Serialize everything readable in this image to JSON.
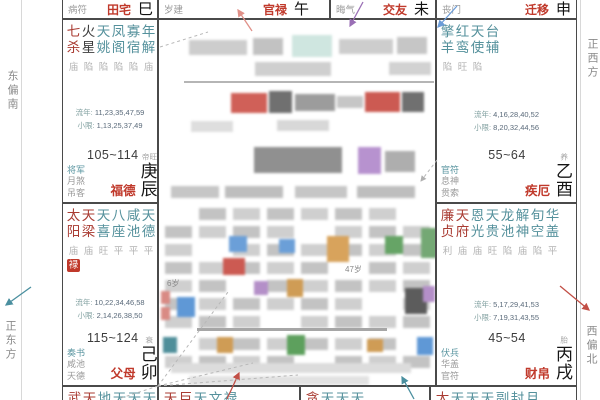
{
  "chart": {
    "directions": {
      "left_top": "东偏南",
      "left_bottom": "正东方",
      "right_top": "正西方",
      "right_bottom": "西偏北"
    },
    "top_strip": [
      {
        "key": "tianzhai",
        "label": "病符",
        "name": "田宅",
        "branch": "巳"
      },
      {
        "key": "guanlu",
        "label": "岁建",
        "name": "官禄",
        "branch": "午"
      },
      {
        "key": "jiaoyou",
        "label": "晦气",
        "name": "交友",
        "branch": "未"
      },
      {
        "key": "qianyi",
        "label": "丧门",
        "name": "迁移",
        "branch": "申"
      }
    ],
    "palaces": [
      {
        "key": "fude",
        "stars": [
          {
            "name": "七杀",
            "status": "庙",
            "type": "major"
          },
          {
            "name": "火星",
            "status": "陷",
            "type": "dark"
          },
          {
            "name": "天姚",
            "status": "陷",
            "type": "minor"
          },
          {
            "name": "凤阁",
            "status": "陷",
            "type": "minor"
          },
          {
            "name": "寡宿",
            "status": "陷",
            "type": "minor"
          },
          {
            "name": "年解",
            "status": "庙",
            "type": "minor"
          }
        ],
        "liunian": {
          "label": "流年:",
          "nums": "11,23,35,47,59"
        },
        "xiaoxian": {
          "label": "小限:",
          "nums": "1,13,25,37,49"
        },
        "shensha": [
          "将军",
          "月煞",
          "吊客"
        ],
        "age": "105~114",
        "name": "福德",
        "stage": "帝旺",
        "stem": "庚",
        "branch": "辰"
      },
      {
        "key": "jie",
        "stars": [
          {
            "name": "擎羊",
            "status": "陷",
            "type": "minor"
          },
          {
            "name": "红鸾",
            "status": "旺",
            "type": "minor"
          },
          {
            "name": "天使",
            "status": "陷",
            "type": "minor"
          },
          {
            "name": "台辅",
            "status": "",
            "type": "minor"
          }
        ],
        "liunian": {
          "label": "流年:",
          "nums": "4,16,28,40,52"
        },
        "xiaoxian": {
          "label": "小限:",
          "nums": "8,20,32,44,56"
        },
        "shensha": [
          "官符",
          "息神",
          "贯索"
        ],
        "age": "55~64",
        "name": "疾厄",
        "stage": "养",
        "stem": "乙",
        "branch": "酉"
      },
      {
        "key": "fumu",
        "stars": [
          {
            "name": "太阳",
            "status": "庙",
            "type": "major",
            "badge": "禄"
          },
          {
            "name": "天梁",
            "status": "庙",
            "type": "major"
          },
          {
            "name": "天喜",
            "status": "旺",
            "type": "minor"
          },
          {
            "name": "八座",
            "status": "平",
            "type": "minor"
          },
          {
            "name": "咸池",
            "status": "平",
            "type": "minor"
          },
          {
            "name": "天德",
            "status": "平",
            "type": "minor"
          }
        ],
        "liunian": {
          "label": "流年:",
          "nums": "10,22,34,46,58"
        },
        "xiaoxian": {
          "label": "小限:",
          "nums": "2,14,26,38,50"
        },
        "shensha": [
          "奏书",
          "咸池",
          "天德"
        ],
        "age": "115~124",
        "name": "父母",
        "stage": "衰",
        "stem": "己",
        "branch": "卯"
      },
      {
        "key": "caibo",
        "stars": [
          {
            "name": "廉贞",
            "status": "利",
            "type": "major"
          },
          {
            "name": "天府",
            "status": "庙",
            "type": "major"
          },
          {
            "name": "恩光",
            "status": "庙",
            "type": "minor"
          },
          {
            "name": "天贵",
            "status": "旺",
            "type": "minor"
          },
          {
            "name": "龙池",
            "status": "陷",
            "type": "minor"
          },
          {
            "name": "解神",
            "status": "庙",
            "type": "minor"
          },
          {
            "name": "旬空",
            "status": "陷",
            "type": "minor"
          },
          {
            "name": "华盖",
            "status": "平",
            "type": "minor"
          }
        ],
        "liunian": {
          "label": "流年:",
          "nums": "5,17,29,41,53"
        },
        "xiaoxian": {
          "label": "小限:",
          "nums": "7,19,31,43,55"
        },
        "shensha": [
          "伏兵",
          "华盖",
          "官符"
        ],
        "age": "45~54",
        "name": "财帛",
        "stage": "胎",
        "stem": "丙",
        "branch": "戌"
      }
    ],
    "bottom_strip": [
      {
        "key": "yin",
        "text": "武天地天天天蜚",
        "red_prefix": 2
      },
      {
        "key": "chou",
        "text": "天巨天文禄",
        "red_prefix": 2
      },
      {
        "key": "zi",
        "text": "贪天天天",
        "red_prefix": 1
      },
      {
        "key": "hai",
        "text": "太天天天副封月",
        "red_prefix": 1
      }
    ],
    "center_notes": {
      "note1": "6岁",
      "note2": "47岁"
    },
    "colors": {
      "major_star": "#a93b32",
      "minor_star": "#55919c",
      "palace_name": "#c0392b",
      "badge_lu_bg": "#c0392b",
      "arrow_red": "#c24f46",
      "arrow_purple": "#9a6fb5",
      "arrow_blue": "#6b9cd8",
      "arrow_teal": "#4a8f9f"
    }
  }
}
